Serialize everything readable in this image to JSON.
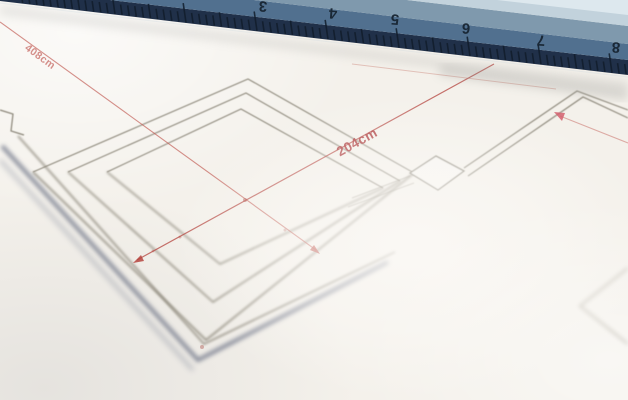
{
  "paper": {
    "base": "#f4f1eb"
  },
  "ruler": {
    "edge": {
      "slope": 0.118,
      "intercept": 1
    },
    "bands": [
      {
        "pts": [
          [
            -9,
            0
          ],
          [
            628,
            75
          ],
          [
            628,
            60
          ],
          [
            110,
            0
          ]
        ],
        "fill": "#203049"
      },
      {
        "pts": [
          [
            110,
            0
          ],
          [
            628,
            60
          ],
          [
            628,
            44
          ],
          [
            254,
            0
          ]
        ],
        "fill": "#51708f"
      },
      {
        "pts": [
          [
            254,
            0
          ],
          [
            628,
            44
          ],
          [
            628,
            26
          ],
          [
            407,
            0
          ]
        ],
        "fill": "#7f99ad"
      },
      {
        "pts": [
          [
            407,
            0
          ],
          [
            628,
            26
          ],
          [
            628,
            0
          ]
        ],
        "fill": "#c2d2dc"
      },
      {
        "pts": [
          [
            497,
            0
          ],
          [
            628,
            15
          ],
          [
            628,
            0
          ]
        ],
        "fill": "#dde8ee"
      }
    ],
    "tick": {
      "start_x": 22.7,
      "spacing": 7.1,
      "count": 86,
      "cm_mod": 3,
      "half_mod": 8,
      "len_mm": 11,
      "len_half": 15,
      "len_cm": 20,
      "dir": [
        -0.14,
        -0.99
      ],
      "color": "#111d2b",
      "width": 1.6,
      "opacity": 0.85
    },
    "numbers": [
      {
        "t": "3",
        "x": 263,
        "y": 6
      },
      {
        "t": "4",
        "x": 333,
        "y": 13
      },
      {
        "t": "5",
        "x": 395,
        "y": 19
      },
      {
        "t": "6",
        "x": 466,
        "y": 28
      },
      {
        "t": "7",
        "x": 541,
        "y": 40
      },
      {
        "t": "8",
        "x": 616,
        "y": 47
      }
    ],
    "number_style": {
      "size": 15,
      "color": "#16222f",
      "rotation": 184
    }
  },
  "plan": {
    "line_color": "#8f8a7d",
    "lines": [
      {
        "pts": [
          [
            33,
            172
          ],
          [
            248,
            79
          ],
          [
            414,
            173
          ]
        ],
        "w": 1.1,
        "b": "s"
      },
      {
        "pts": [
          [
            33,
            172
          ],
          [
            206,
            340
          ],
          [
            414,
            173
          ]
        ],
        "w": 1.6,
        "b": "m"
      },
      {
        "pts": [
          [
            68,
            172
          ],
          [
            246,
            93
          ],
          [
            400,
            181
          ]
        ],
        "w": 1.1,
        "b": "s"
      },
      {
        "pts": [
          [
            68,
            172
          ],
          [
            213,
            302
          ],
          [
            400,
            181
          ]
        ],
        "w": 1.5,
        "b": "m"
      },
      {
        "pts": [
          [
            107,
            172
          ],
          [
            241,
            109
          ],
          [
            383,
            188
          ]
        ],
        "w": 1.1,
        "b": "s"
      },
      {
        "pts": [
          [
            107,
            172
          ],
          [
            220,
            264
          ],
          [
            383,
            188
          ]
        ],
        "w": 1.4,
        "b": "m"
      },
      {
        "pts": [
          [
            18,
            136
          ],
          [
            204,
            344
          ],
          [
            395,
            252
          ]
        ],
        "w": 1.5,
        "b": "m",
        "c": "#8a8578"
      },
      {
        "pts": [
          [
            2,
            146
          ],
          [
            198,
            360
          ],
          [
            388,
            262
          ]
        ],
        "w": 4.0,
        "b": "l",
        "c": "#6e7587",
        "op": 0.8
      },
      {
        "pts": [
          [
            0,
            160
          ],
          [
            193,
            370
          ]
        ],
        "w": 3.5,
        "b": "x",
        "c": "#7d8496",
        "op": 0.45
      },
      {
        "pts": [
          [
            0,
            110
          ],
          [
            13,
            114
          ],
          [
            11,
            131
          ],
          [
            24,
            135
          ]
        ],
        "w": 1.2,
        "b": "s",
        "c": "#8a8578"
      },
      {
        "pts": [
          [
            464,
            168
          ],
          [
            577,
            91
          ],
          [
            628,
            110
          ]
        ],
        "w": 1.2,
        "b": "s"
      },
      {
        "pts": [
          [
            468,
            176
          ],
          [
            583,
            97
          ],
          [
            628,
            118
          ]
        ],
        "w": 1.2,
        "b": "s"
      },
      {
        "pts": [
          [
            410,
            176
          ],
          [
            352,
            198
          ]
        ],
        "w": 1.1,
        "b": "s",
        "op": 0.55
      },
      {
        "pts": [
          [
            414,
            183
          ],
          [
            348,
            207
          ]
        ],
        "w": 1.1,
        "b": "s",
        "op": 0.5
      },
      {
        "pts": [
          [
            628,
            268
          ],
          [
            580,
            306
          ],
          [
            628,
            344
          ]
        ],
        "w": 1.6,
        "b": "l",
        "c": "#a9a498",
        "op": 0.65
      }
    ],
    "box": {
      "pts": [
        [
          410,
          173
        ],
        [
          436,
          156
        ],
        [
          464,
          171
        ],
        [
          438,
          190
        ]
      ],
      "fill": "#f7f5f1",
      "stroke": "#8a8578",
      "w": 1.3
    },
    "dots": [
      [
        245,
        200,
        2,
        0.5
      ],
      [
        180,
        237,
        1.5,
        0.35
      ],
      [
        285,
        230,
        1.5,
        0.35
      ],
      [
        202,
        347,
        2,
        0.4
      ],
      [
        153,
        251,
        1.4,
        0.3
      ]
    ],
    "dot_color": "#a84a44"
  },
  "dimensions": {
    "items": [
      {
        "label": "408cm",
        "line": [
          [
            0,
            22
          ],
          [
            316,
            250
          ]
        ],
        "w": 1.1,
        "color": "#c0574f",
        "op": 0.65,
        "arrow": [
          [
            320,
            254
          ],
          [
            310,
            250
          ],
          [
            314,
            245
          ]
        ],
        "label_pos": [
          40,
          57
        ],
        "label_rot": 36,
        "label_size": 10.5,
        "label_color": "#c4625c",
        "label_op": 0.7
      },
      {
        "label": "204cm",
        "line": [
          [
            137,
            260
          ],
          [
            494,
            64
          ]
        ],
        "w": 1.2,
        "color": "#b5443e",
        "op": 0.75,
        "arrow": [
          [
            133,
            263
          ],
          [
            141,
            255
          ],
          [
            144,
            261
          ]
        ],
        "label_pos": [
          357,
          142
        ],
        "label_rot": -29,
        "label_size": 13.5,
        "label_color": "#ad3a3c",
        "label_op": 0.9
      },
      {
        "label": "",
        "line": [
          [
            560,
            116
          ],
          [
            628,
            143
          ]
        ],
        "w": 1.1,
        "color": "#c0574f",
        "op": 0.45,
        "arrow": [
          [
            554,
            112
          ],
          [
            565,
            113
          ],
          [
            562,
            121
          ]
        ],
        "arrow_color": "#d4606e"
      },
      {
        "label": "",
        "line": [
          [
            352,
            64
          ],
          [
            556,
            89
          ]
        ],
        "w": 1.0,
        "color": "#c87a6e",
        "op": 0.4
      }
    ]
  }
}
